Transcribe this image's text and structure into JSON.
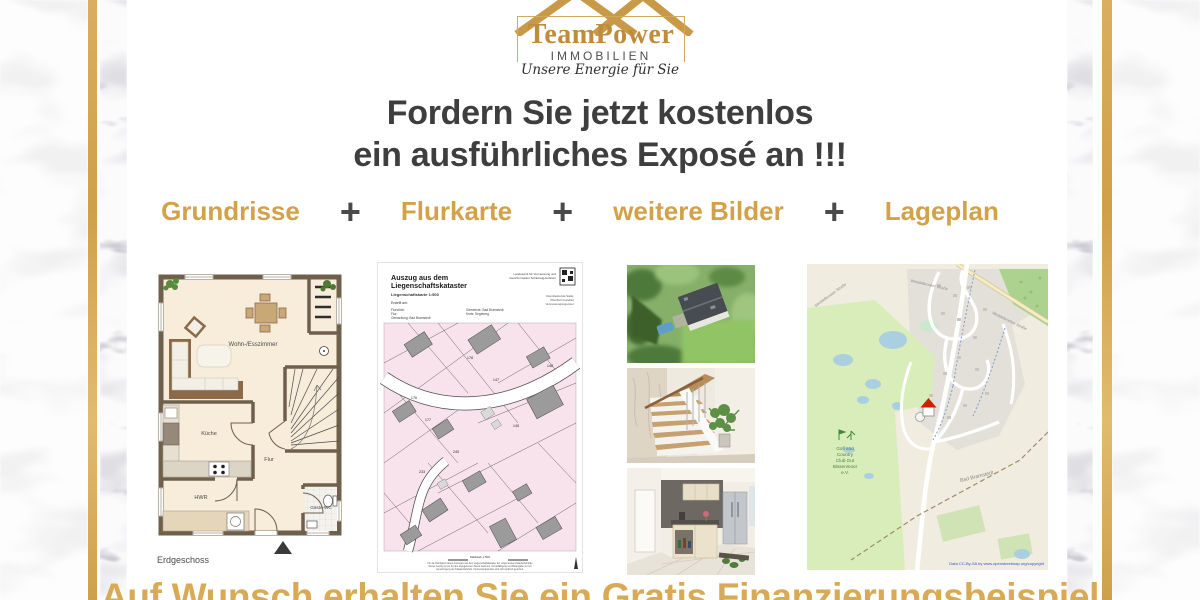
{
  "logo": {
    "brand": "TeamPower",
    "subtitle": "IMMOBILIEN",
    "tagline": "Unsere Energie für Sie"
  },
  "headline": {
    "line1": "Fordern Sie jetzt kostenlos",
    "line2": "ein ausführliches Exposé an !!!"
  },
  "features": {
    "separator": "+",
    "items": [
      "Grundrisse",
      "Flurkarte",
      "weitere Bilder",
      "Lageplan"
    ]
  },
  "floorplan": {
    "caption": "Erdgeschoss",
    "rooms": {
      "living": "Wohn-/Esszimmer",
      "kitchen": "Küche",
      "hall": "Flur",
      "utility": "HWR",
      "wc": "Gäste-WC"
    }
  },
  "cadastral": {
    "title1": "Auszug aus dem",
    "title2": "Liegenschaftskataster",
    "subtitle": "Liegenschaftskarte 1:500",
    "created": "Erstellt am:",
    "meta1": "Flurstück:",
    "meta2": "Flur:",
    "meta3": "Gemarkung: Bad Bramstedt",
    "meta4": "Gemeinde: Bad Bramstedt",
    "meta5": "Kreis: Segeberg",
    "issuer1": "Landesamt für Vermessung und",
    "issuer2": "Geoinformation Schleswig-Holstein",
    "office1": "Dienstleistende Stelle:",
    "office2": "Öffentlich bestellter",
    "office3": "Vermessungsingenieur",
    "scale": "Maßstab 1:500",
    "foot1": "Für die Richtigkeit dieses Auszuges aus dem Liegenschaftskataster der vorgenannten Katasterbehörde",
    "foot2": "Dieser Auszug ist nur für den angegebenen Zweck bestimmt. Vervielfältigung und Weitergabe nur mit",
    "foot3": "Genehmigung der Katasterbehörde. Vermessungspunkte sind nicht grafisch gesichert.",
    "parcels": [
      "147",
      "148",
      "176",
      "177",
      "145",
      "233",
      "245",
      "178"
    ]
  },
  "map": {
    "street": "Weddelbrooker Straße",
    "town": "Bad Bramstedt",
    "golf1": "Golf and",
    "golf2": "Country",
    "golf3": "Club Gut",
    "golf4": "Bissenmoor",
    "golf5": "e.V.",
    "copyright": "Data CC-By-SA by www.openstreetmap.org/copyright"
  },
  "footer": {
    "text": "Auf Wunsch erhalten Sie ein Gratis Finanzierungsbeispiel"
  },
  "colors": {
    "gold": "#d2a149",
    "heading_gray": "#3e3e3e",
    "cadastral_pink": "#f8e3ec",
    "map_green": "#d9edbb"
  }
}
